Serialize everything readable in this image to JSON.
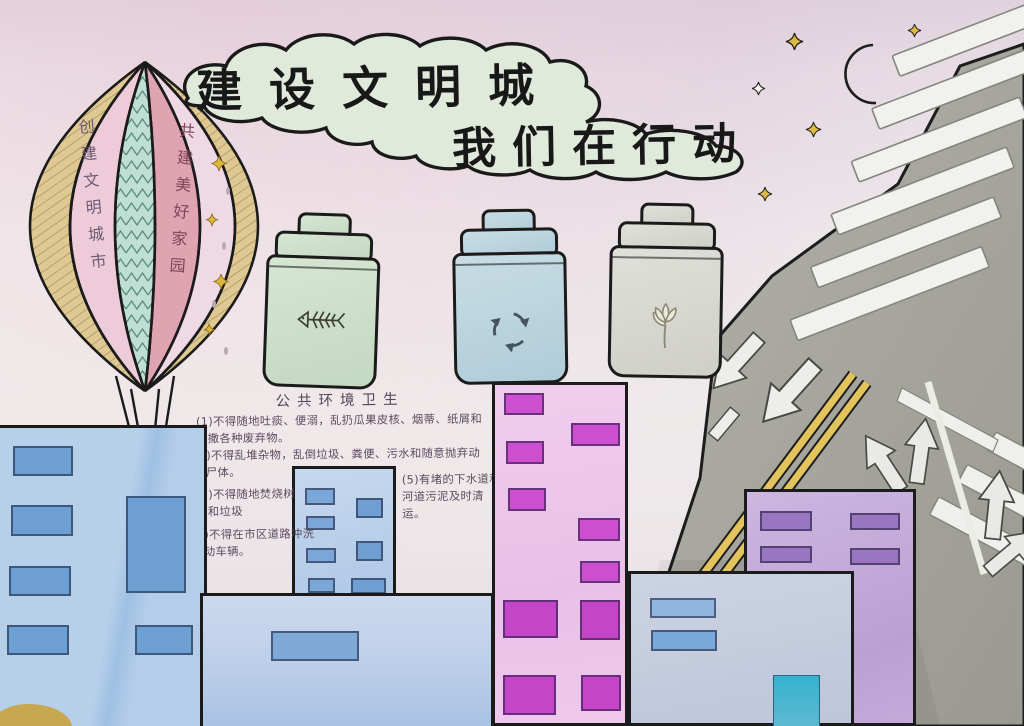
{
  "poster": {
    "title_line1": "建设文明城",
    "title_line2": "我们在行动",
    "balloon_left_banner": "创建文明城市",
    "balloon_right_banner": "共建美好家园",
    "sanitation_heading": "公共环境卫生",
    "sanitation_rules": [
      "(1)不得随地吐痰、便溺，乱扔瓜果皮核、烟蒂、纸屑和抛撒各种废弃物。",
      "(2)不得乱堆杂物，乱倒垃圾、粪便、污水和随意抛弃动物尸体。",
      "(3)不得随地焚烧树叶和垃圾",
      "(4)不得在市区道路冲洗机动车辆。",
      "(5)有堵的下水道和河道污泥及时清运。"
    ],
    "bins": [
      {
        "type": "kitchen-waste-bin",
        "icon": "fishbone-icon",
        "body_color": "#cbdfc9"
      },
      {
        "type": "recyclable-bin",
        "icon": "recycle-arrows-icon",
        "body_color": "#bdd8e1"
      },
      {
        "type": "other-waste-bin",
        "icon": "flower-icon",
        "body_color": "#dbdbd5"
      }
    ],
    "sky": {
      "moon_icon": "crescent-moon-icon",
      "moon_color": "#e9d35c",
      "star_icon": "four-point-star-icon",
      "star_colors": [
        "#dcbb40",
        "#f6f3ea"
      ],
      "star_count": 6
    },
    "road": {
      "surface_color": "#a9a9a1",
      "marking_color": "#f0f1ec",
      "center_line_color": "#e3c35c",
      "markings": [
        "zebra-crossing-icon",
        "down-left-arrow-icon",
        "fork-arrow-icon",
        "double-yellow-line",
        "lane-line"
      ]
    },
    "palette": {
      "paper_top": "#e2d4de",
      "paper_mid": "#f1edec",
      "cloud_fill": "#dfeadb",
      "ink_outline": "#1b1b1b",
      "handwriting": "#5c4b61"
    }
  }
}
